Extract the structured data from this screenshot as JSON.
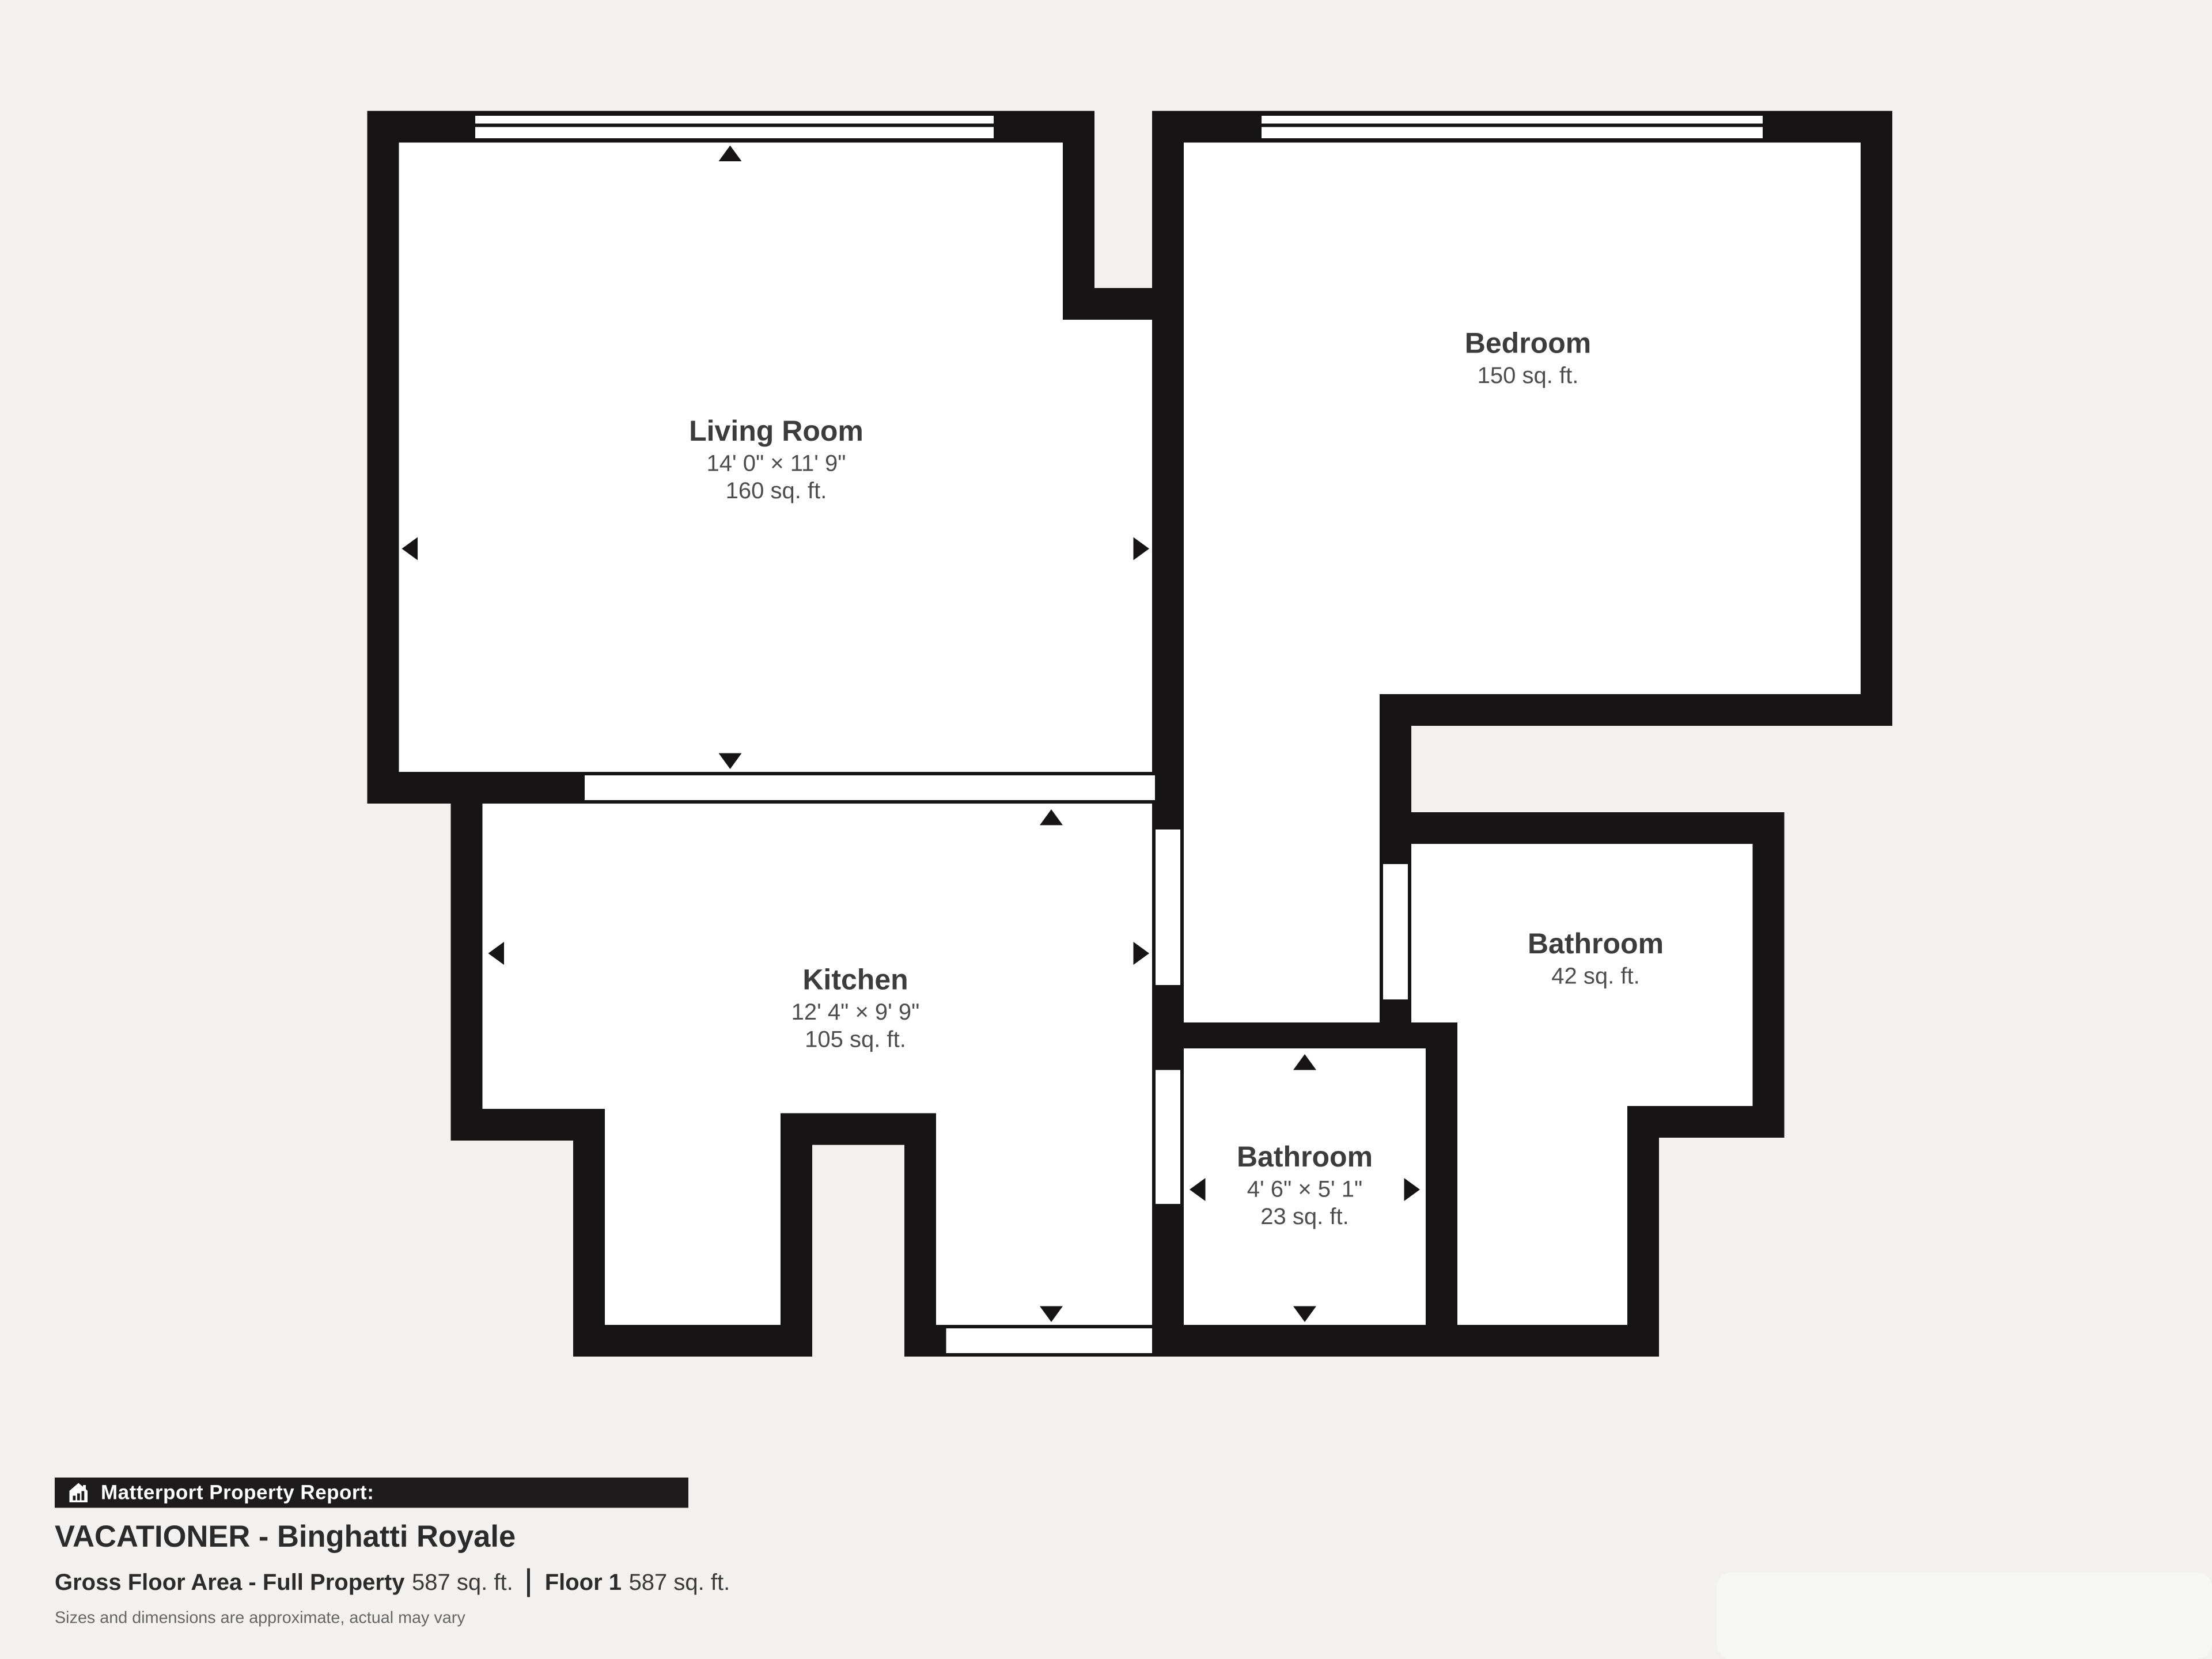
{
  "plan": {
    "colors": {
      "background": "#f2f1ef",
      "wall": "#161414",
      "room_fill": "#ffffff",
      "label": "#3c3c3c",
      "sublabel": "#4d4d4d"
    },
    "rooms": [
      {
        "name": "Living Room",
        "dims": "14' 0\" × 11' 9\"",
        "area": "160 sq. ft."
      },
      {
        "name": "Bedroom",
        "area": "150 sq. ft."
      },
      {
        "name": "Kitchen",
        "dims": "12' 4\" × 9' 9\"",
        "area": "105 sq. ft."
      },
      {
        "name": "Bathroom",
        "area": "42 sq. ft."
      },
      {
        "name": "Bathroom",
        "dims": "4' 6\" × 5' 1\"",
        "area": "23 sq. ft."
      }
    ],
    "icons": {
      "report": "house-chart-icon",
      "dimension_markers": "triangle-arrow-icons"
    }
  },
  "footer": {
    "report_label": "Matterport Property Report:",
    "property_name": "VACATIONER - Binghatti Royale",
    "gross_label": "Gross Floor Area - Full Property",
    "gross_value": "587 sq. ft.",
    "floor_label": "Floor 1",
    "floor_value": "587 sq. ft.",
    "disclaimer": "Sizes and dimensions are approximate, actual may vary"
  }
}
